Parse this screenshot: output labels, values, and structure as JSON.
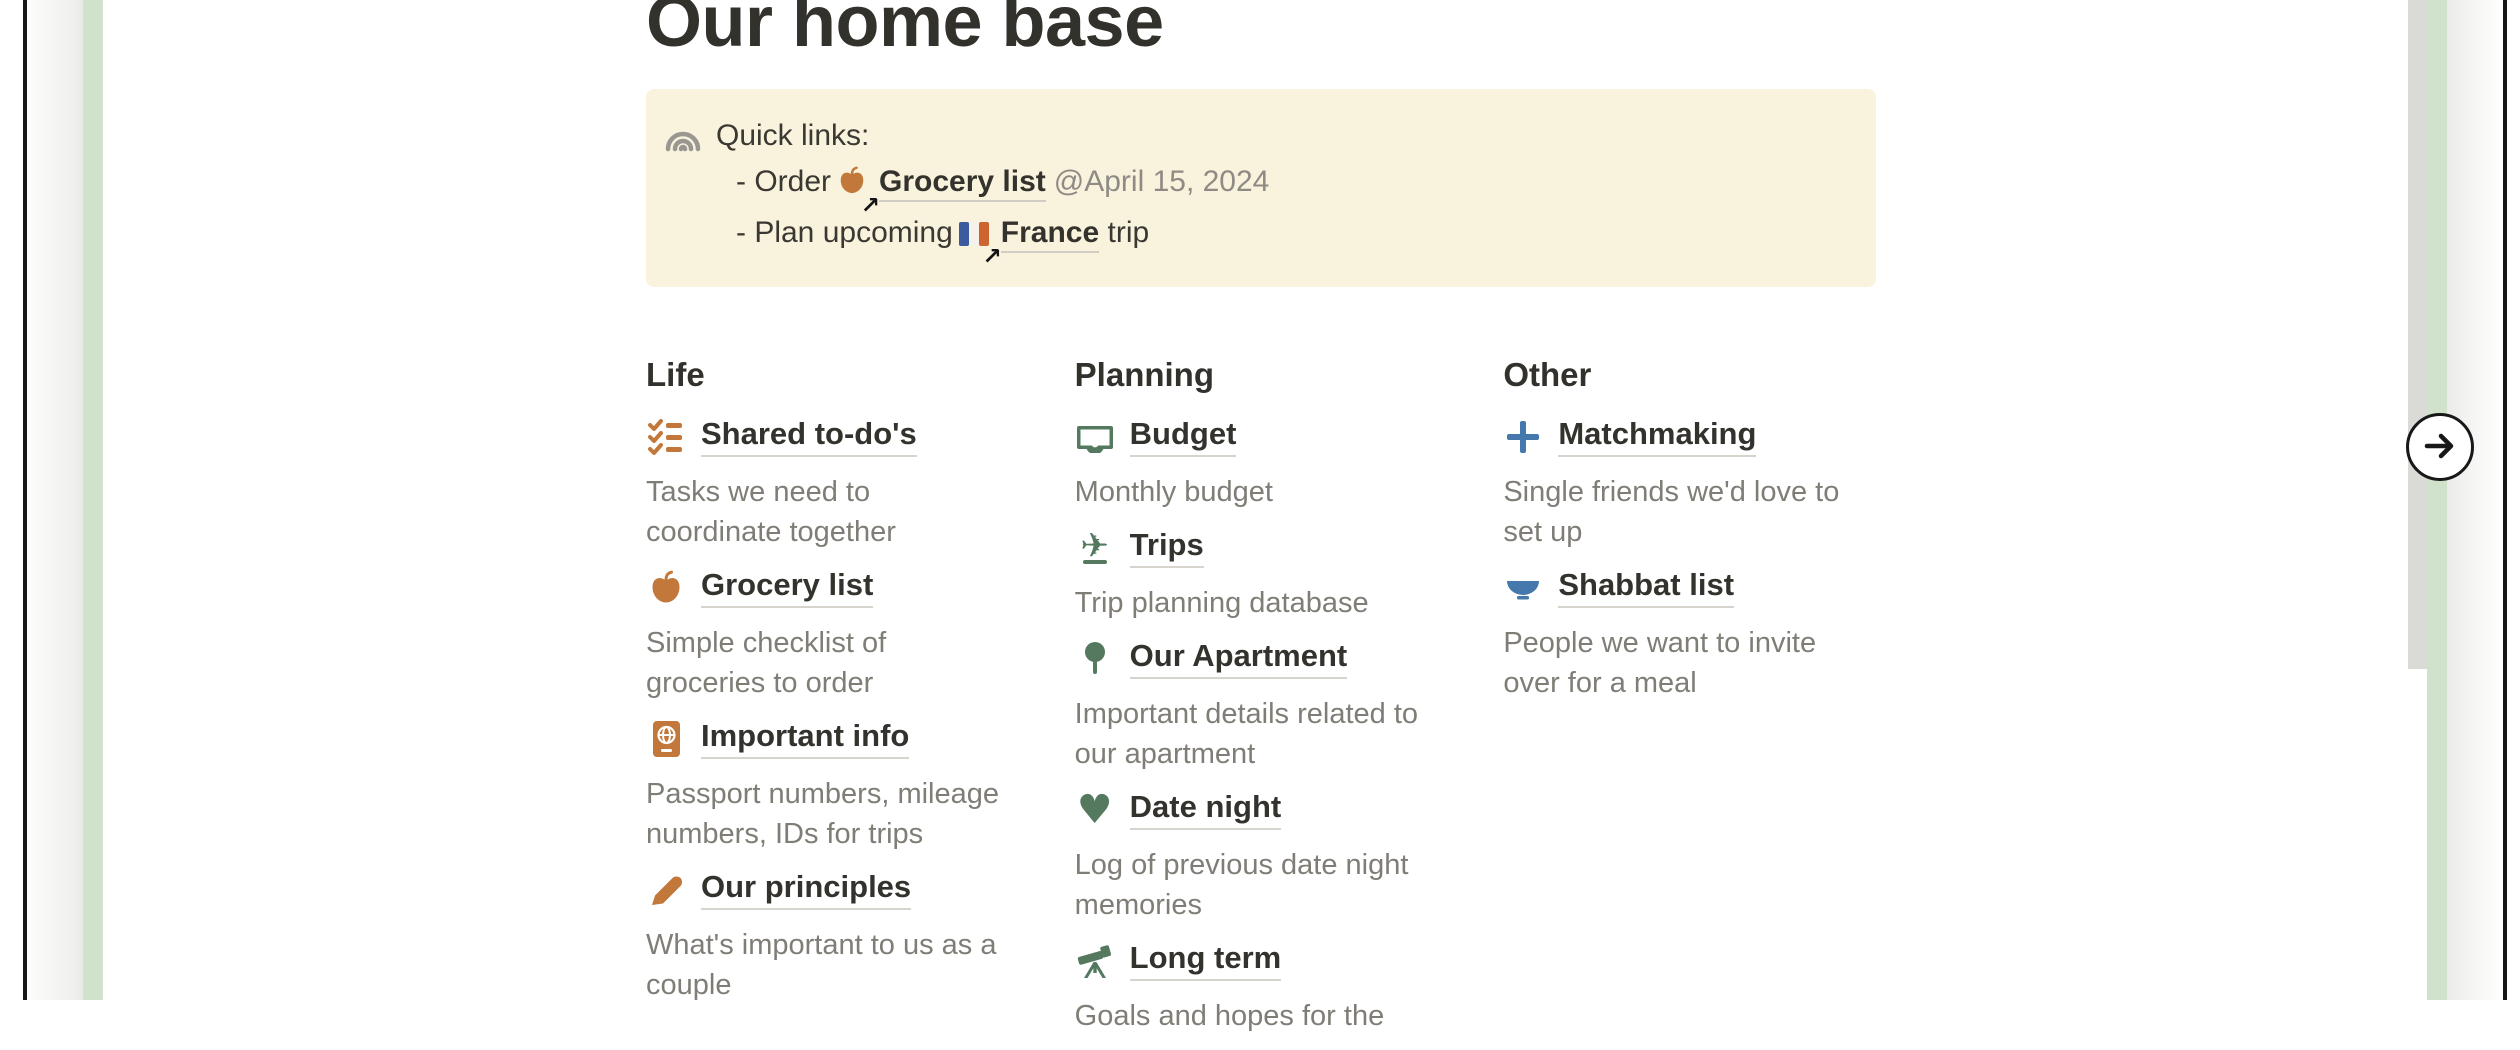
{
  "page": {
    "title": "Our home base"
  },
  "callout": {
    "icon": "rainbow-icon",
    "background": "#f9f2dc",
    "title": "Quick links:",
    "lines": [
      {
        "prefix": "- Order",
        "icon": "apple-icon",
        "link": "Grocery list",
        "mention": "@April 15, 2024"
      },
      {
        "prefix": "- Plan upcoming",
        "icon": "france-flag-icon",
        "link": "France",
        "suffix": " trip"
      }
    ]
  },
  "columns": [
    {
      "heading": "Life",
      "items": [
        {
          "icon": "checklist-icon",
          "label": "Shared to-do's",
          "description": "Tasks we need to\ncoordinate together"
        },
        {
          "icon": "apple-icon",
          "label": "Grocery list",
          "description": "Simple checklist of\ngroceries to order"
        },
        {
          "icon": "passport-icon",
          "label": "Important info",
          "description": "Passport numbers, mileage\nnumbers, IDs for trips"
        },
        {
          "icon": "pencil-icon",
          "label": "Our principles",
          "description": "What's important to us as a\ncouple"
        }
      ]
    },
    {
      "heading": "Planning",
      "items": [
        {
          "icon": "money-icon",
          "label": "Budget",
          "description": "Monthly budget"
        },
        {
          "icon": "airplane-icon",
          "label": "Trips",
          "description": "Trip planning database"
        },
        {
          "icon": "pin-icon",
          "label": "Our Apartment",
          "description": "Important details related to\nour apartment"
        },
        {
          "icon": "heart-icon",
          "label": "Date night",
          "description": "Log of previous date night\nmemories"
        },
        {
          "icon": "telescope-icon",
          "label": "Long term",
          "description": "Goals and hopes for the"
        }
      ]
    },
    {
      "heading": "Other",
      "items": [
        {
          "icon": "plus-icon",
          "label": "Matchmaking",
          "description": "Single friends we'd love to\nset up"
        },
        {
          "icon": "bowl-icon",
          "label": "Shabbat list",
          "description": "People we want to invite\nover for a meal"
        }
      ]
    }
  ],
  "carousel": {
    "next_button_icon": "arrow-right-icon"
  },
  "colors": {
    "accent_orange": "#c2773b",
    "accent_green": "#54795f",
    "accent_blue": "#4579ad",
    "green_border": "#d0e1cc",
    "callout_bg": "#f9f2dc",
    "text_dark": "#33322d",
    "text_gray": "#7f7d76"
  }
}
